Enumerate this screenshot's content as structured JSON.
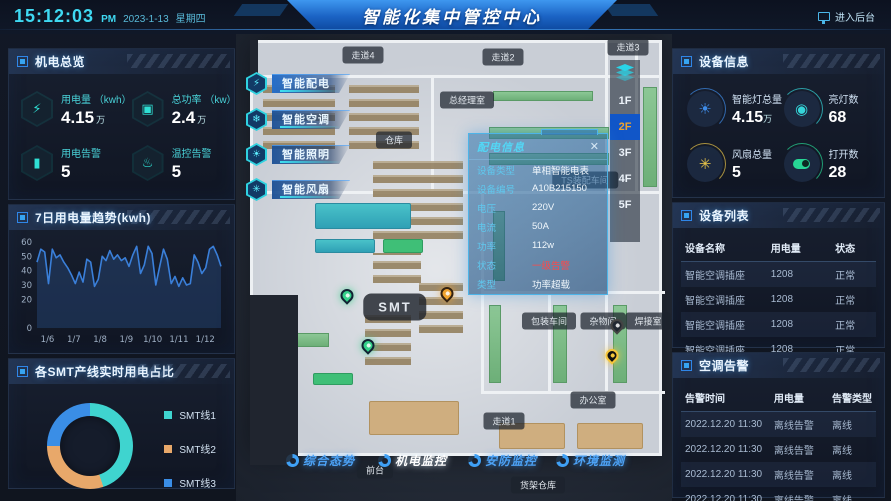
{
  "header": {
    "time": "15:12:03",
    "meridiem": "PM",
    "date": "2023-1-13",
    "weekday": "星期四",
    "title": "智能化集中管控中心",
    "backend_label": "进入后台",
    "backend_icon": "monitor-icon"
  },
  "left": {
    "overview": {
      "title": "机电总览",
      "stats": [
        {
          "label": "用电量 （kwh）",
          "value": "4.15",
          "unit": "万",
          "icon": "lightning-icon"
        },
        {
          "label": "总功率 （kw）",
          "value": "2.4",
          "unit": "万",
          "icon": "monitor-icon"
        },
        {
          "label": "用电告警",
          "value": "5",
          "unit": "",
          "icon": "battery-icon"
        },
        {
          "label": "温控告警",
          "value": "5",
          "unit": "",
          "icon": "thermometer-icon"
        }
      ]
    },
    "trend_title": "7日用电量趋势(kwh)",
    "smt_title": "各SMT产线实时用电占比"
  },
  "map": {
    "buttons": [
      {
        "label": "智能配电",
        "icon": "lightning-icon",
        "active": true
      },
      {
        "label": "智能空调",
        "icon": "snowflake-icon",
        "active": false
      },
      {
        "label": "智能照明",
        "icon": "light-icon",
        "active": false
      },
      {
        "label": "智能风扇",
        "icon": "fan-icon",
        "active": false
      }
    ],
    "floor_selector": {
      "icon": "layers-icon",
      "options": [
        "1F",
        "2F",
        "3F",
        "4F",
        "5F"
      ],
      "active": "2F"
    },
    "rooms": [
      "走道4",
      "走道2",
      "走道3",
      "总经理室",
      "仓库",
      "SMT",
      "TS装配车间",
      "包装车间",
      "杂物间",
      "焊接室",
      "办公室",
      "走道1",
      "前台",
      "货架仓库"
    ],
    "pins": [
      {
        "status": "normal"
      },
      {
        "status": "normal"
      },
      {
        "status": "warning"
      },
      {
        "status": "alarm"
      },
      {
        "status": "offline"
      }
    ],
    "popup": {
      "title": "配电信息",
      "close_label": "✕",
      "fields": [
        {
          "label": "设备类型",
          "value": "单相智能电表",
          "alert": false
        },
        {
          "label": "设备编号",
          "value": "A10B215150",
          "alert": false
        },
        {
          "label": "电压",
          "value": "220V",
          "alert": false
        },
        {
          "label": "电流",
          "value": "50A",
          "alert": false
        },
        {
          "label": "功率",
          "value": "112w",
          "alert": false
        },
        {
          "label": "状态",
          "value": "一级告警",
          "alert": true
        },
        {
          "label": "类型",
          "value": "功率超载",
          "alert": false
        }
      ]
    },
    "bottom_nav": [
      {
        "label": "综合态势",
        "icon": "overview-icon",
        "active": false
      },
      {
        "label": "机电监控",
        "icon": "mechatronic-icon",
        "active": true
      },
      {
        "label": "安防监控",
        "icon": "security-icon",
        "active": false
      },
      {
        "label": "环境监测",
        "icon": "environment-icon",
        "active": false
      }
    ]
  },
  "right": {
    "device_info": {
      "title": "设备信息",
      "stats": [
        {
          "label": "智能灯总量",
          "value": "4.15",
          "unit": "万",
          "icon": "bulb-icon",
          "color": "#3f8ce8"
        },
        {
          "label": "亮灯数",
          "value": "68",
          "unit": "",
          "icon": "flashlight-icon",
          "color": "#35d4d8"
        },
        {
          "label": "风扇总量",
          "value": "5",
          "unit": "",
          "icon": "fan-icon",
          "color": "#e8c54a"
        },
        {
          "label": "打开数",
          "value": "28",
          "unit": "",
          "icon": "toggle-icon",
          "color": "#27d695"
        }
      ]
    },
    "device_list": {
      "title": "设备列表",
      "headers": [
        "设备名称",
        "用电量",
        "状态"
      ],
      "rows": [
        [
          "智能空调插座",
          "1208",
          "正常"
        ],
        [
          "智能空调插座",
          "1208",
          "正常"
        ],
        [
          "智能空调插座",
          "1208",
          "正常"
        ],
        [
          "智能空调插座",
          "1208",
          "正常"
        ]
      ]
    },
    "ac_alarms": {
      "title": "空调告警",
      "headers": [
        "告警时间",
        "用电量",
        "告警类型"
      ],
      "rows": [
        [
          "2022.12.20  11:30",
          "离线告警",
          "离线"
        ],
        [
          "2022.12.20  11:30",
          "离线告警",
          "离线"
        ],
        [
          "2022.12.20  11:30",
          "离线告警",
          "离线"
        ],
        [
          "2022.12.20  11:30",
          "离线告警",
          "离线"
        ]
      ]
    }
  },
  "chart_data": [
    {
      "type": "line",
      "title": "7日用电量趋势(kwh)",
      "x_tick_labels": [
        "1/6",
        "1/7",
        "1/8",
        "1/9",
        "1/10",
        "1/11",
        "1/12"
      ],
      "values": [
        46,
        55,
        53,
        31,
        55,
        49,
        51,
        46,
        42,
        37,
        31,
        39,
        32,
        48,
        46,
        29,
        34,
        50,
        47,
        54,
        48,
        51,
        47,
        49,
        43,
        51,
        57,
        38,
        44,
        57,
        52,
        30,
        43,
        55,
        48,
        31,
        36,
        29,
        35,
        30,
        31,
        51,
        46,
        38,
        42,
        55,
        57,
        51,
        43
      ],
      "ylim": [
        0,
        60
      ],
      "yticks": [
        60,
        50,
        40,
        30,
        20,
        0
      ],
      "grid": false,
      "line_color": "#3a7fd9",
      "area_color": "rgba(56,110,190,0.25)"
    },
    {
      "type": "pie",
      "subtype": "donut",
      "title": "各SMT产线实时用电占比",
      "legend_position": "right",
      "series": [
        {
          "name": "SMT线1",
          "value": 45,
          "color": "#3fd4cf"
        },
        {
          "name": "SMT线2",
          "value": 30,
          "color": "#e8a86a"
        },
        {
          "name": "SMT线3",
          "value": 25,
          "color": "#3a8ee6"
        }
      ]
    }
  ],
  "colors": {
    "accent_cyan": "#3fd9f2",
    "accent_blue": "#2e7fe0",
    "active_floor_bg": "#1156c8",
    "active_floor_text": "#f0a32f",
    "alert_red": "#ff4848"
  }
}
